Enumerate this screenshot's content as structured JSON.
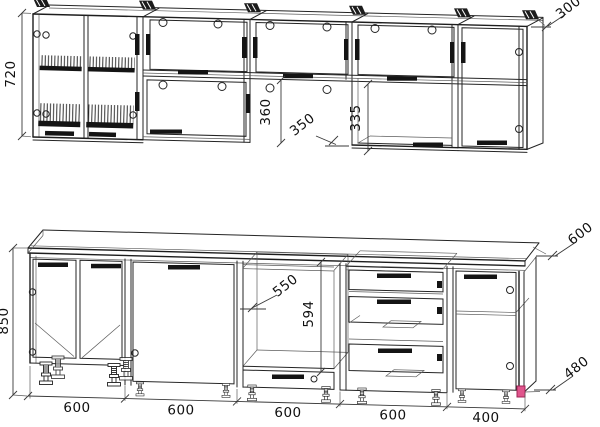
{
  "drawing": {
    "kind": "kitchen-cabinet-technical-drawing",
    "views": [
      "wall-cabinets-row",
      "base-cabinets-row"
    ]
  },
  "colors": {
    "background": "#ffffff",
    "line": "#242424",
    "dimension_line": "#383838",
    "text": "#101010",
    "highlight_marker": "#e0558c"
  },
  "wall_units": {
    "height": "720",
    "depth": "300",
    "dim_360": "360",
    "dim_350": "350",
    "dim_335": "335"
  },
  "base_units": {
    "height": "850",
    "worktop_depth": "600",
    "dim_550": "550",
    "dim_594": "594",
    "dim_480": "480",
    "widths": [
      "600",
      "600",
      "600",
      "600",
      "400"
    ]
  }
}
